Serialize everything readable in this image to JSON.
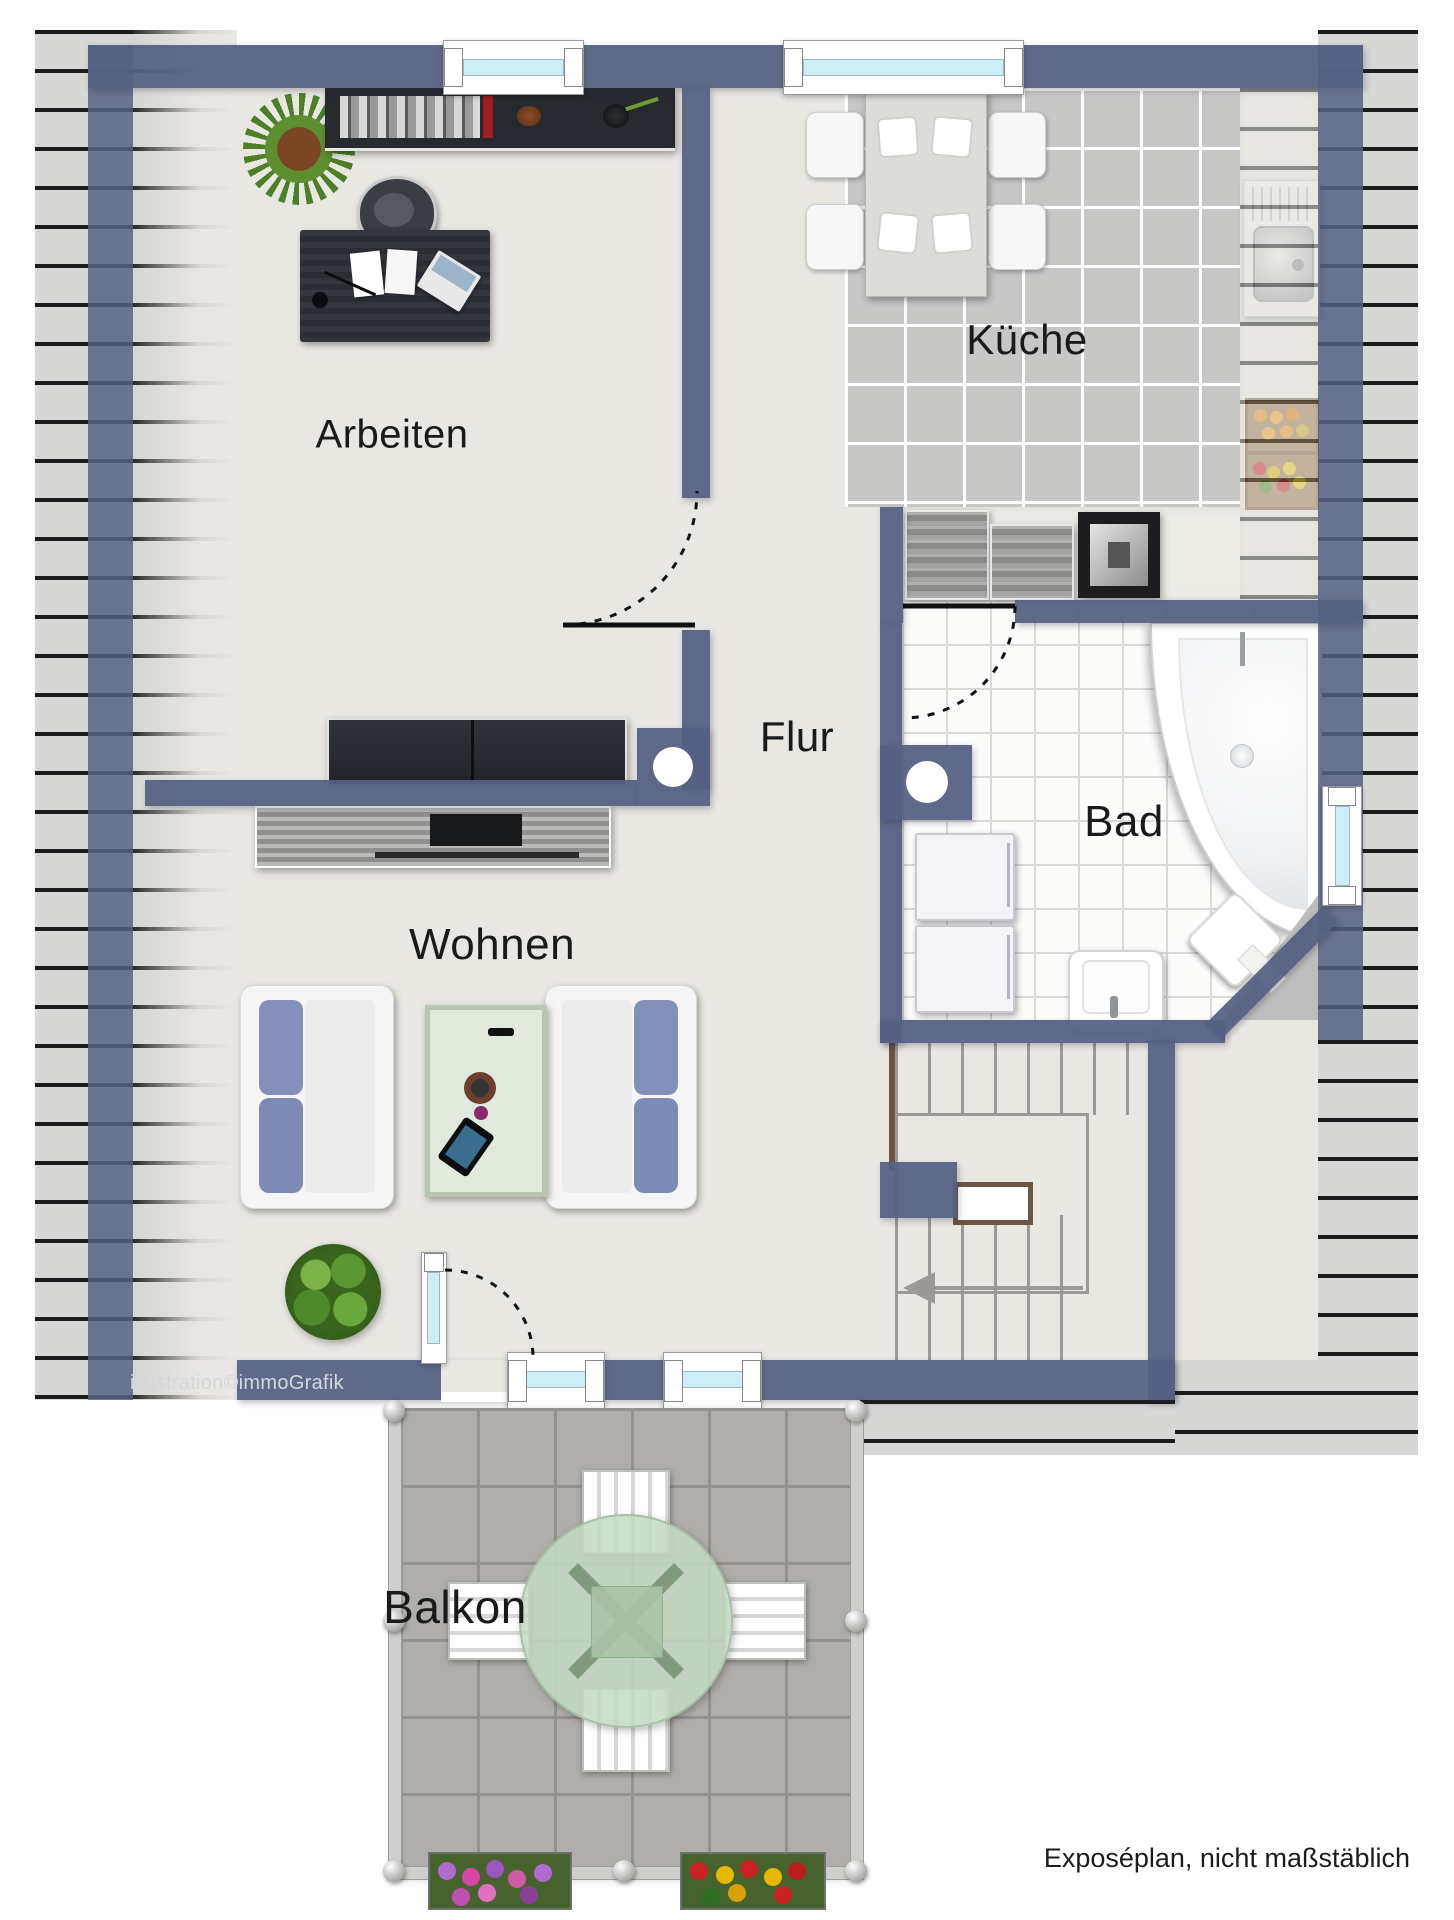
{
  "plan": {
    "rooms": [
      {
        "id": "arbeiten",
        "label": "Arbeiten"
      },
      {
        "id": "kueche",
        "label": "Küche"
      },
      {
        "id": "flur",
        "label": "Flur"
      },
      {
        "id": "bad",
        "label": "Bad"
      },
      {
        "id": "wohnen",
        "label": "Wohnen"
      },
      {
        "id": "balkon",
        "label": "Balkon"
      }
    ],
    "watermark": "illustration©immoGrafik",
    "footer_note": "Exposéplan, nicht maßstäblich",
    "colors": {
      "wall": "#566082",
      "floor": "#e9e7e2",
      "kitchen_tile": "#c7c7c6",
      "bath_tile": "#fcfcfb",
      "roof_stripe_bg": "#d7d7d6",
      "roof_stripe_line": "#1c1c1c",
      "balcony_paver": "#b0aeab",
      "window_glass": "#cdeef6",
      "handrail": "#6b5545",
      "sofa_cushion": "#8290ba",
      "table_glass": "#c6d8c4"
    }
  }
}
